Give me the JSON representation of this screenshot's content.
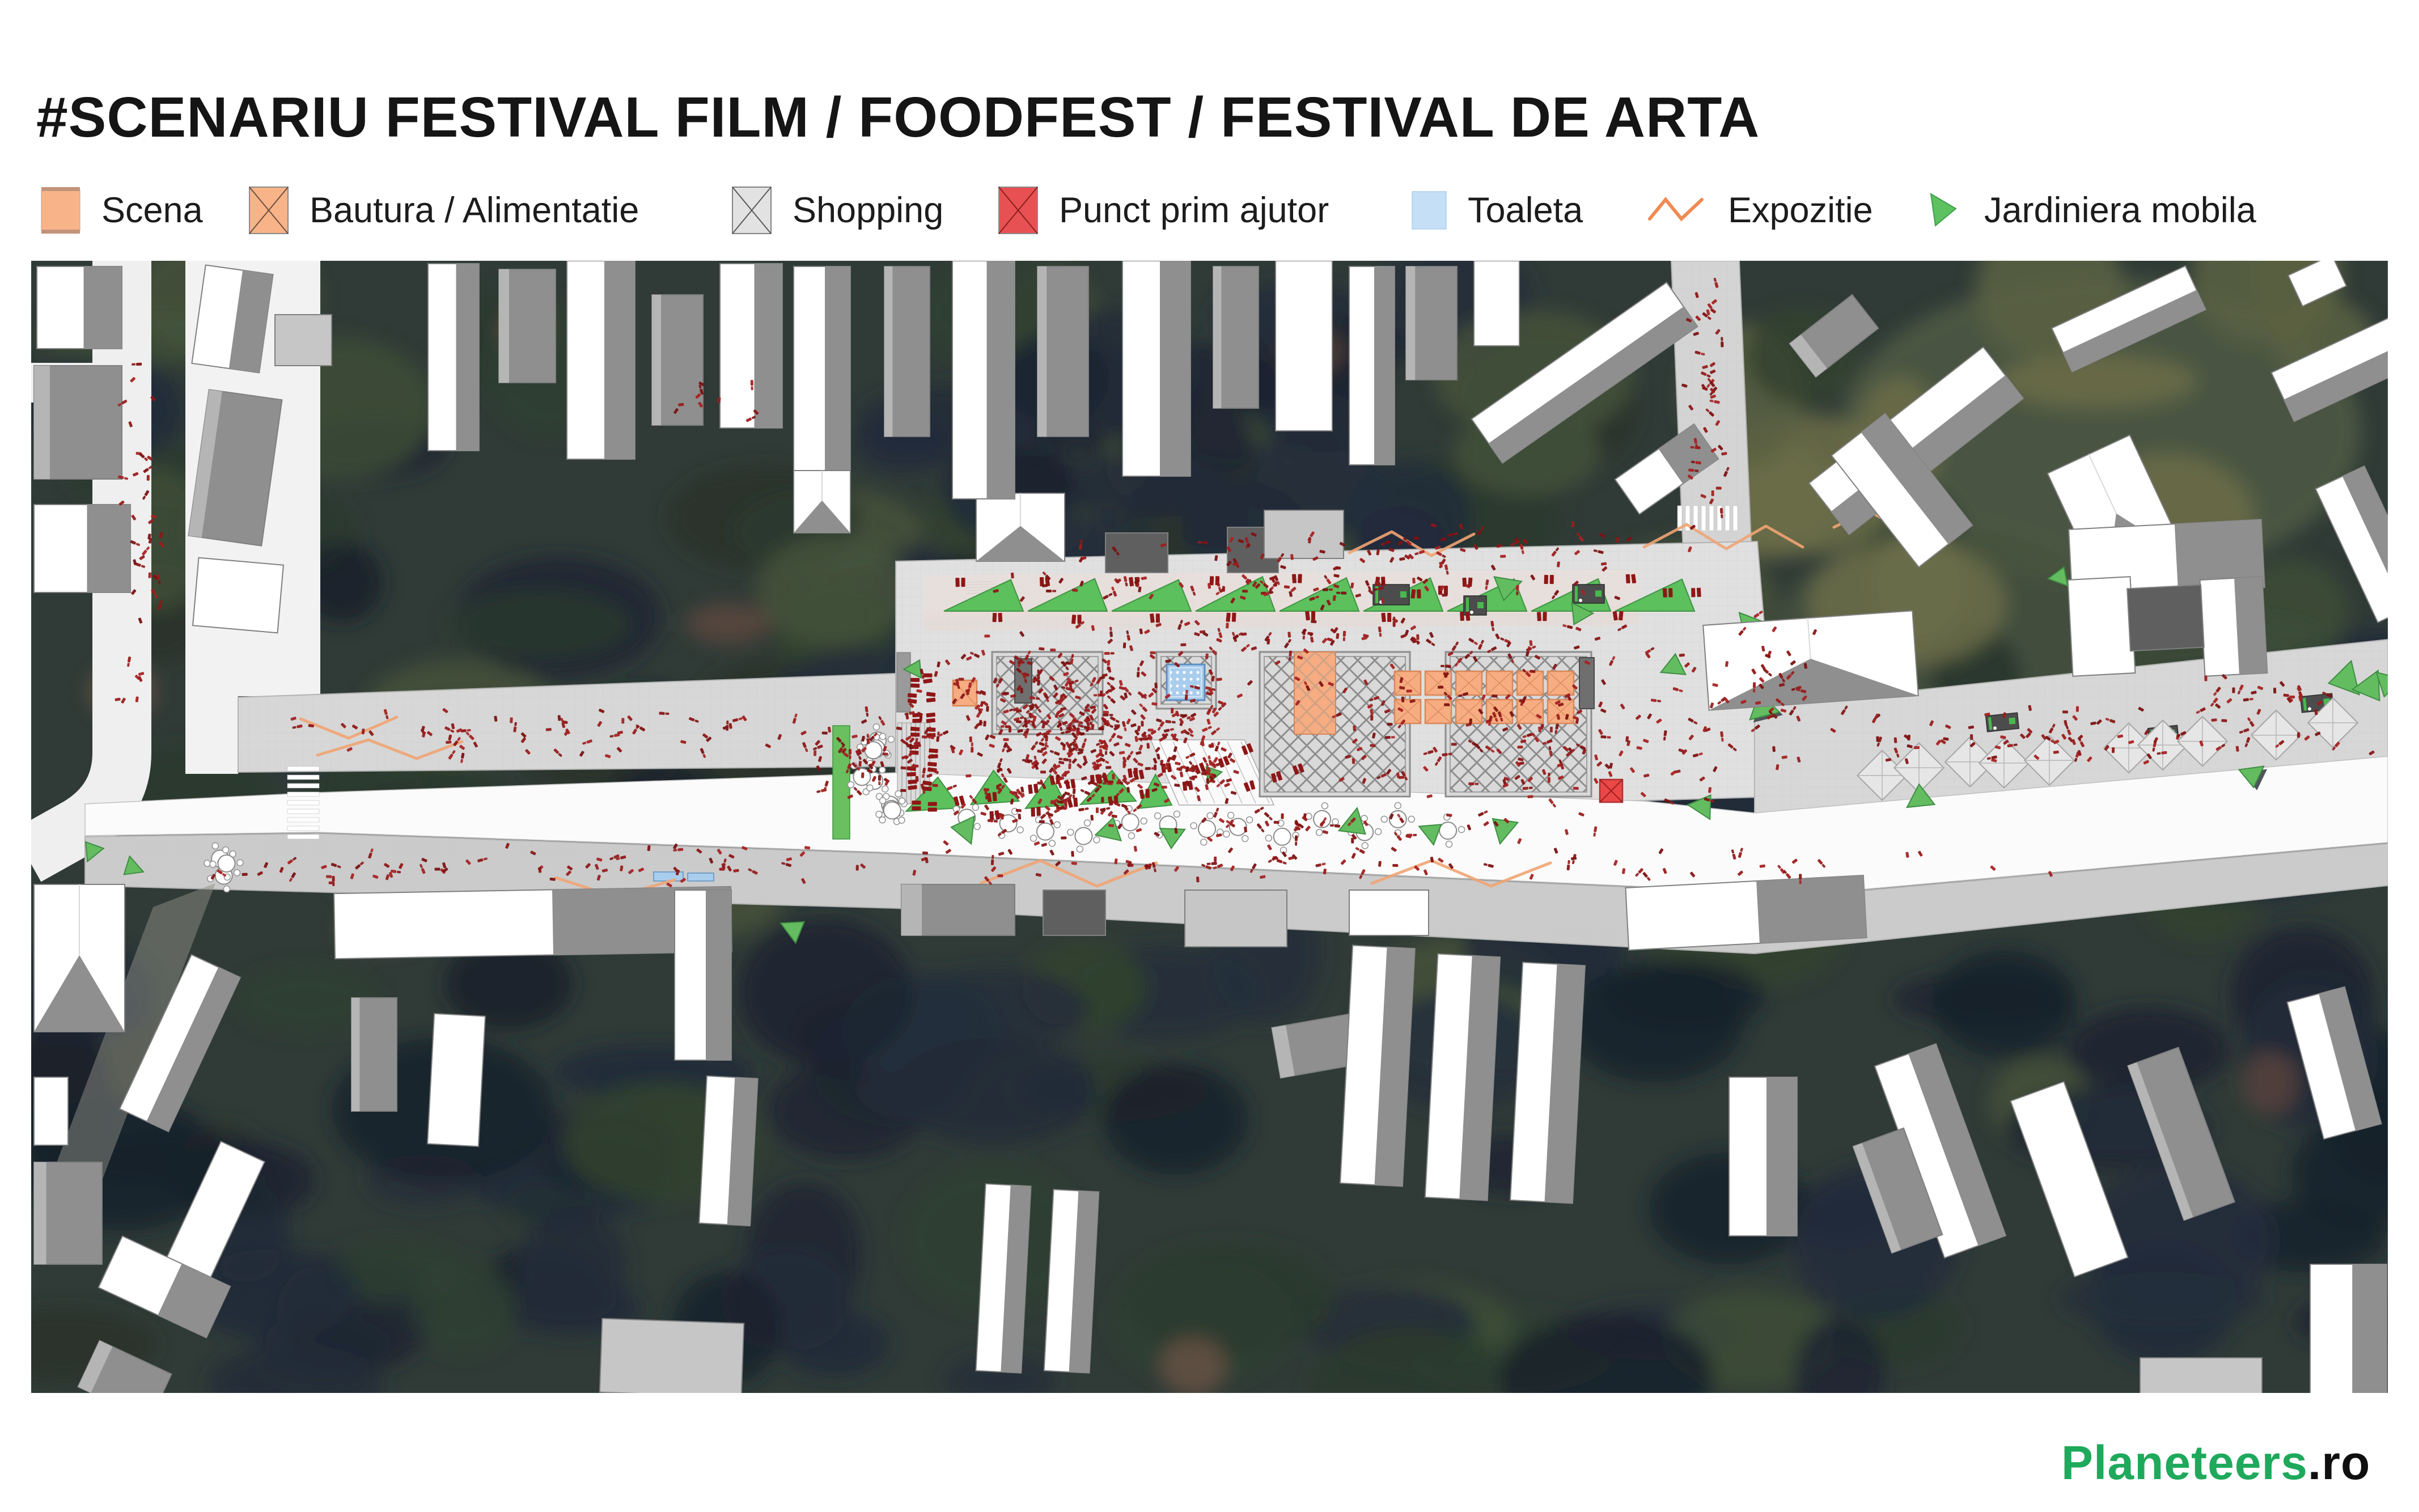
{
  "header": {
    "title": "#SCENARIU FESTIVAL FILM / FOODFEST / FESTIVAL DE ARTA"
  },
  "legend": {
    "items": [
      {
        "id": "scena",
        "label": "Scena",
        "type": "solid-square",
        "color": "#F8B488"
      },
      {
        "id": "bautura-alimentatie",
        "label": "Bautura / Alimentatie",
        "type": "cross-square",
        "color": "#F8B488"
      },
      {
        "id": "shopping",
        "label": "Shopping",
        "type": "cross-square",
        "color": "#E2E2E2"
      },
      {
        "id": "punct-prim-ajutor",
        "label": "Punct prim ajutor",
        "type": "cross-square",
        "color": "#E85153"
      },
      {
        "id": "toaleta",
        "label": "Toaleta",
        "type": "solid-square",
        "color": "#C4DFF6"
      },
      {
        "id": "expozitie",
        "label": "Expozitie",
        "type": "zigzag-line",
        "color": "#F08A50"
      },
      {
        "id": "jardiniera-mobila",
        "label": "Jardiniera mobila",
        "type": "triangle",
        "color": "#5EC15F"
      }
    ]
  },
  "map": {
    "kind": "festival-site-plan-over-aerial-photo",
    "colors": {
      "people": "#8C1717",
      "stage_orange": "#F7AD81",
      "stage_border": "#D8885A",
      "toilet_blue": "#A9CDEC",
      "toilet_border": "#5D8FC0",
      "first_aid_red": "#EA4747",
      "greenery": "#63BD60",
      "greenery_dark": "#3E8D42",
      "expo_line": "#F0A473",
      "paving": "#E0E0E0",
      "walkway": "#D7D7D7",
      "sidewalk": "#CBCBCB",
      "road_white": "#FBFBFB",
      "lattice": "#8D8D8D",
      "building_roof": "#FFFFFF",
      "building_shade": "#8F8F8F",
      "kiosk_dark": "#4C4C4C",
      "trees_base": "#303B37"
    }
  },
  "footer": {
    "brand": {
      "name": "Planeteers",
      "tld": ".ro",
      "color": "#1FA95C"
    }
  }
}
